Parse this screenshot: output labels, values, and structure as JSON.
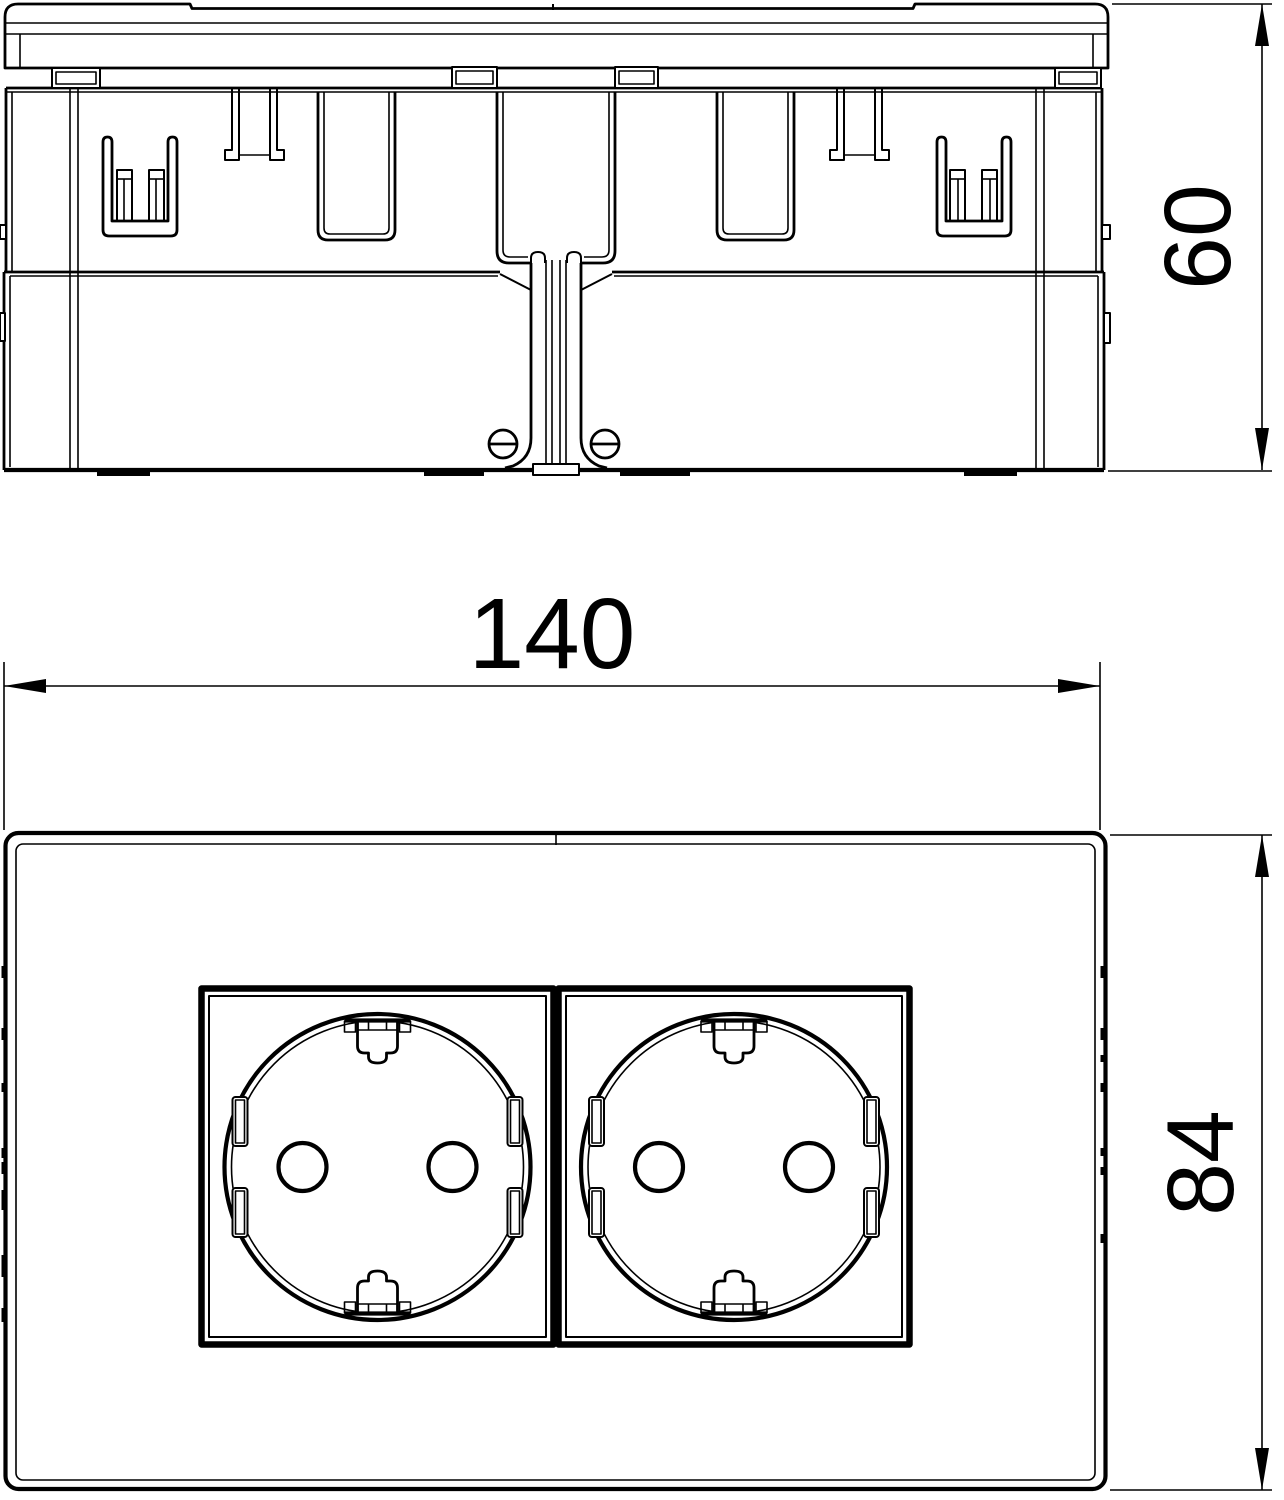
{
  "drawing": {
    "background_color": "#ffffff",
    "line_color": "#000000",
    "views": {
      "side_view": {
        "depth_dimension": {
          "value": "60"
        }
      },
      "front_view": {
        "width_dimension": {
          "value": "140"
        },
        "height_dimension": {
          "value": "84"
        }
      }
    }
  }
}
